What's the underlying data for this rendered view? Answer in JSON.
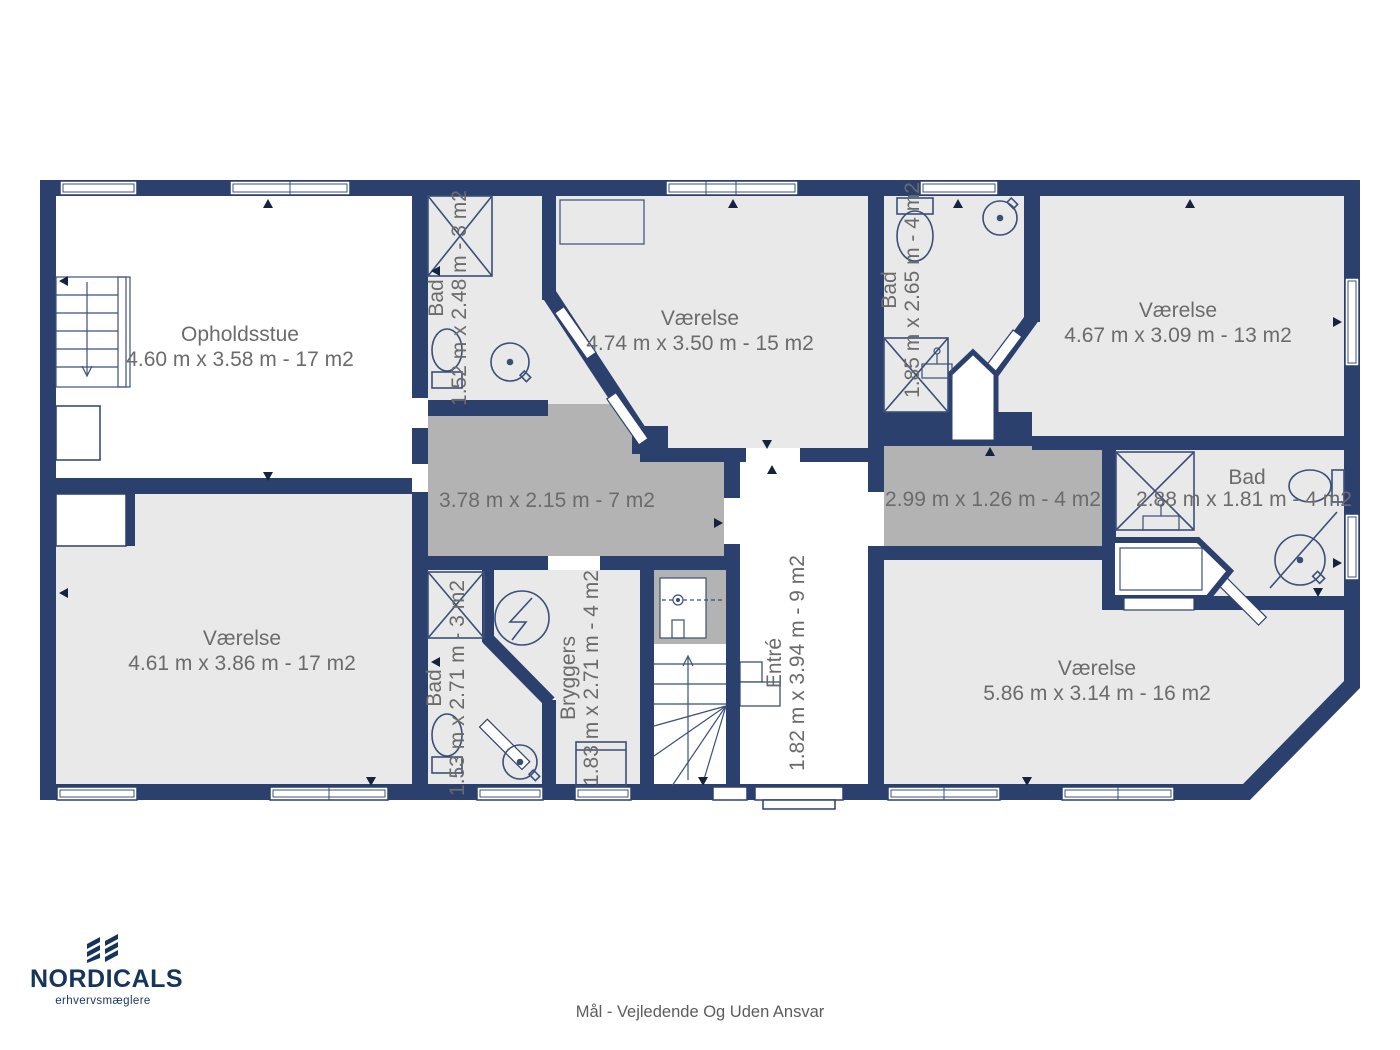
{
  "page": {
    "footer": "Mål - Vejledende Og Uden Ansvar"
  },
  "branding": {
    "logo_text": "NORDICALS",
    "tagline": "erhvervsmæglere",
    "logo_mark": "diagonal-stripes-monogram"
  },
  "colors": {
    "wall_navy": "#2c406e",
    "room_fill": "#e9e9e9",
    "hall_fill": "#b3b3b3",
    "room_white": "#ffffff",
    "label_gray": "#6b6b6b",
    "logo_navy": "#16355c",
    "footer_gray": "#5c5c5c"
  },
  "icons": {
    "stairs_down": "staircase with down arrow",
    "stairs_up": "staircase with up arrow",
    "shower": "square with diagonal cross",
    "toilet": "tank with oval bowl",
    "washbasin": "circle with center dot and spout",
    "sink": "small vanity with tap",
    "bathtub": "outlined tub",
    "boiler": "circle with zigzag",
    "washer": "square appliance"
  },
  "rooms": [
    {
      "name": "Opholdsstue",
      "dims": "4.60 m x 3.58 m - 17 m2"
    },
    {
      "name": "Bad",
      "dims": "1.52 m x 2.48 m - 3 m2"
    },
    {
      "name": "Værelse",
      "dims": "4.74 m x 3.50 m - 15 m2"
    },
    {
      "name": "Bad",
      "dims": "1.85 m x 2.65 m - 4 m2"
    },
    {
      "name": "Værelse",
      "dims": "4.67 m x 3.09 m - 13 m2"
    },
    {
      "name": "",
      "dims": "3.78 m x 2.15 m - 7 m2"
    },
    {
      "name": "",
      "dims": "2.99 m x 1.26 m - 4 m2"
    },
    {
      "name": "Bad",
      "dims": "2.88 m x 1.81 m - 4 m2"
    },
    {
      "name": "Værelse",
      "dims": "4.61 m x 3.86 m - 17 m2"
    },
    {
      "name": "Bad",
      "dims": "1.53 m x 2.71 m - 3 m2"
    },
    {
      "name": "Bryggers",
      "dims": "1.83 m x 2.71 m - 4 m2"
    },
    {
      "name": "Entré",
      "dims": "1.82 m x 3.94 m - 9 m2"
    },
    {
      "name": "Værelse",
      "dims": "5.86 m x 3.14 m - 16 m2"
    }
  ]
}
